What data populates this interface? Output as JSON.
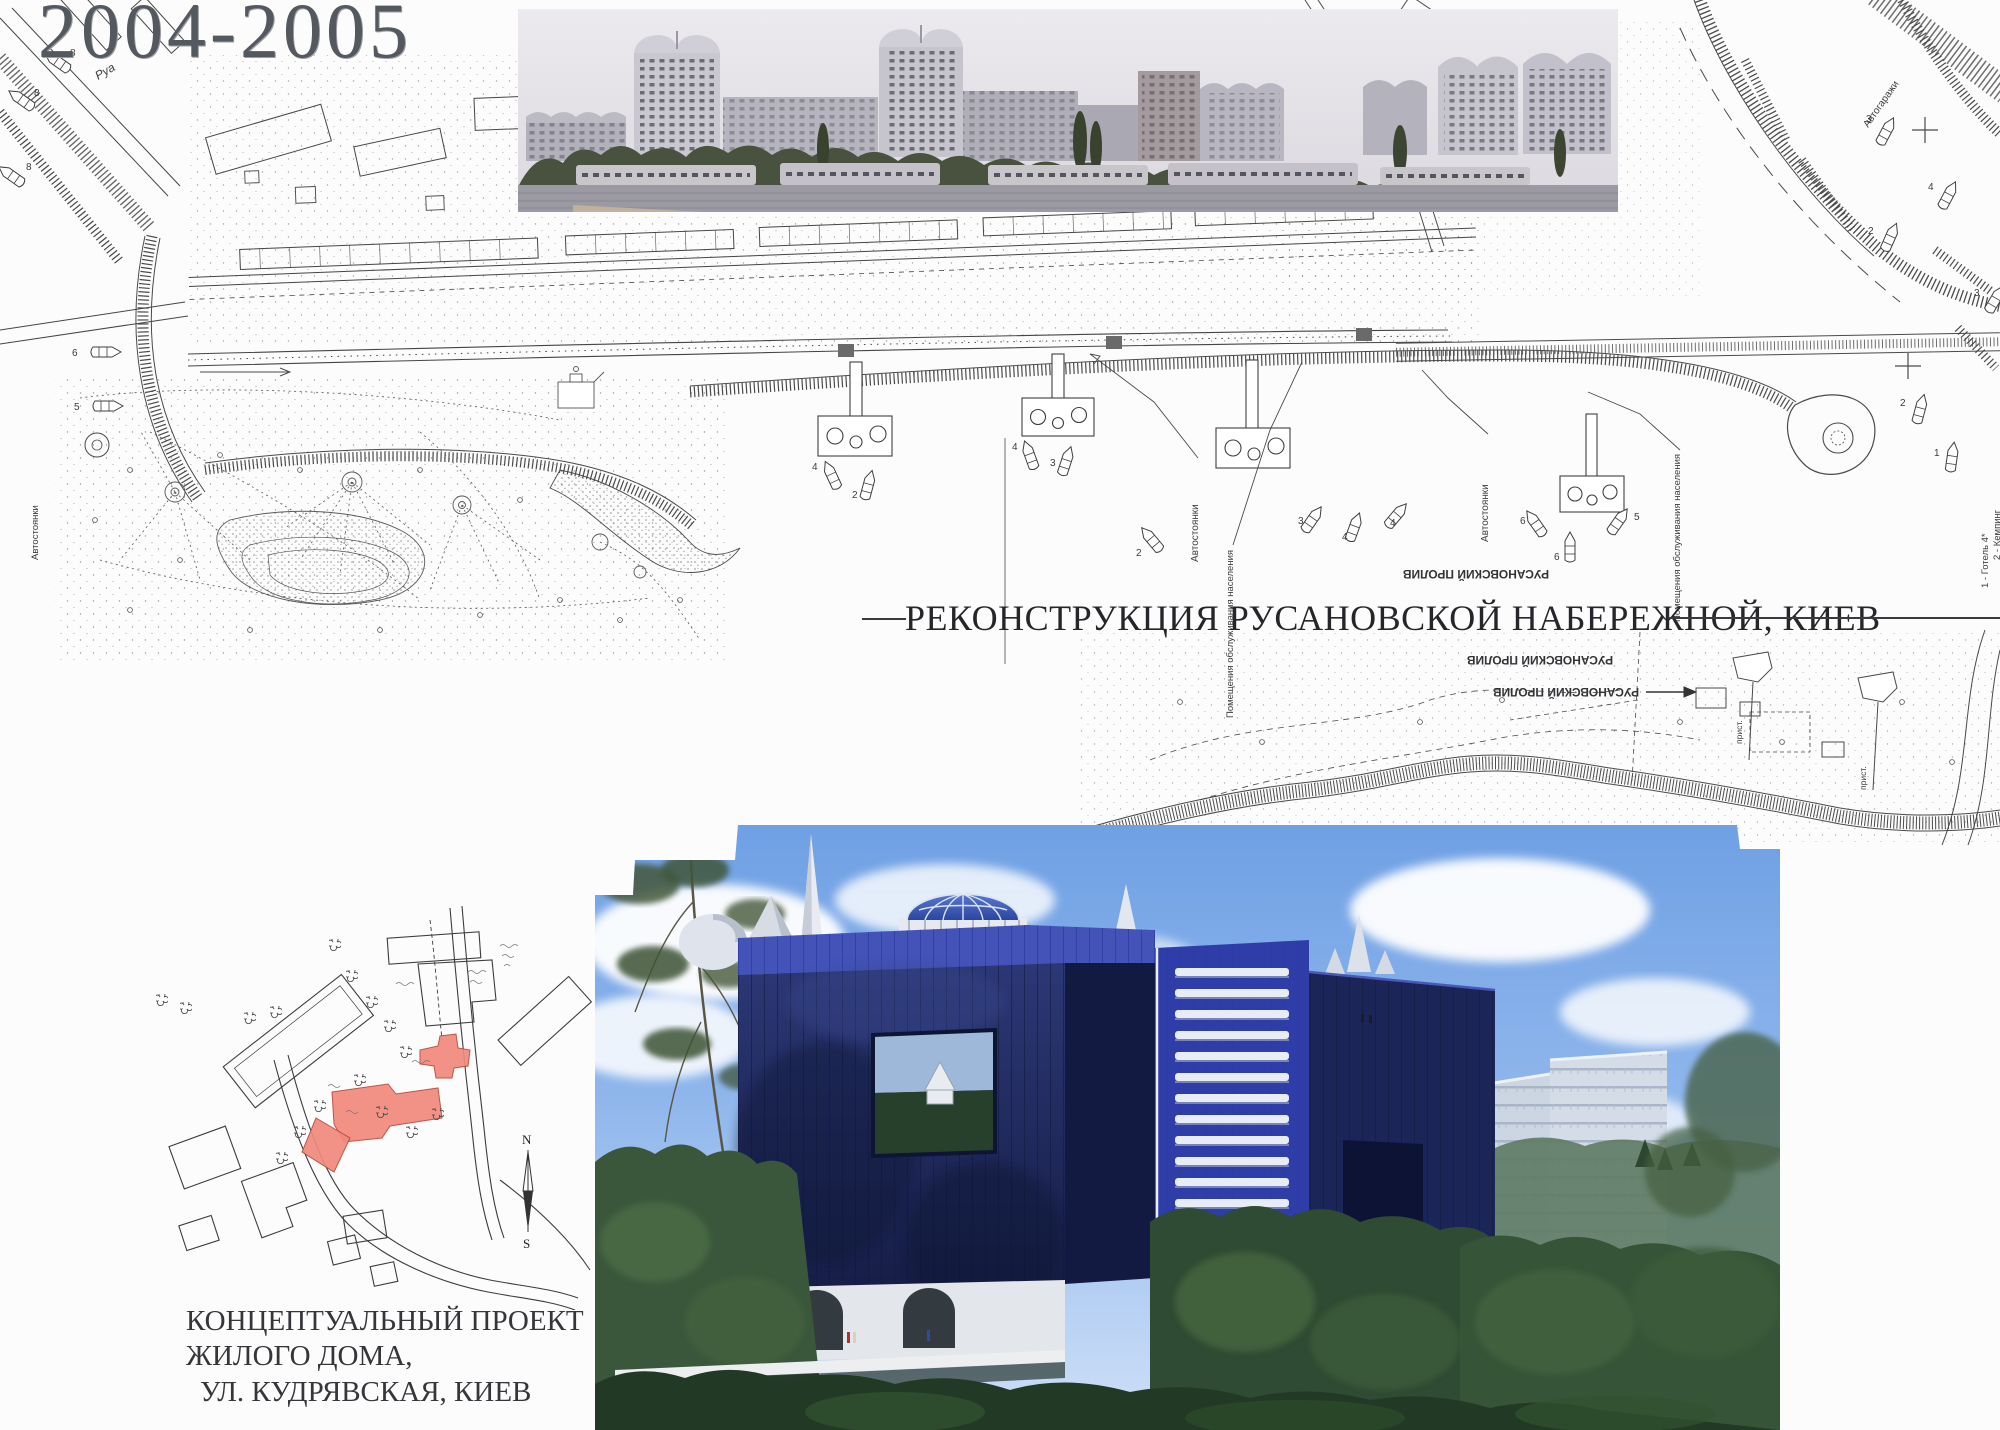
{
  "page": {
    "title": "2004-2005"
  },
  "embankment": {
    "caption": "РЕКОНСТРУКЦИЯ РУСАНОВСКОЙ НАБЕРЕЖНОЙ, КИЕВ",
    "labels": {
      "strait": "РУСАНОВСКИЙ ПРОЛИВ",
      "parking": "Автостоянки",
      "services": "Помещения обслуживания населения",
      "garages": "Автогаражи",
      "pier_abbr": "прист.",
      "street_abbr": "Руа",
      "legend_hotel": "1 - Готель 4*",
      "legend_camping": "2 - Кемпинг"
    },
    "boat_numbers": {
      "n1": "1",
      "n2": "2",
      "n3": "3",
      "n4": "4",
      "n5": "5",
      "n6": "6",
      "n8": "8"
    }
  },
  "kudriavska": {
    "caption_line1": "КОНЦЕПТУАЛЬНЫЙ ПРОЕКТ",
    "caption_line2": "ЖИЛОГО ДОМА,",
    "caption_line3": "УЛ. КУДРЯВСКАЯ, КИЕВ",
    "compass_north": "N",
    "compass_south": "S"
  },
  "colors": {
    "accent_red": "#f2897c",
    "building_blue": "#2a35a0",
    "map_ink": "#3f3f3f"
  }
}
